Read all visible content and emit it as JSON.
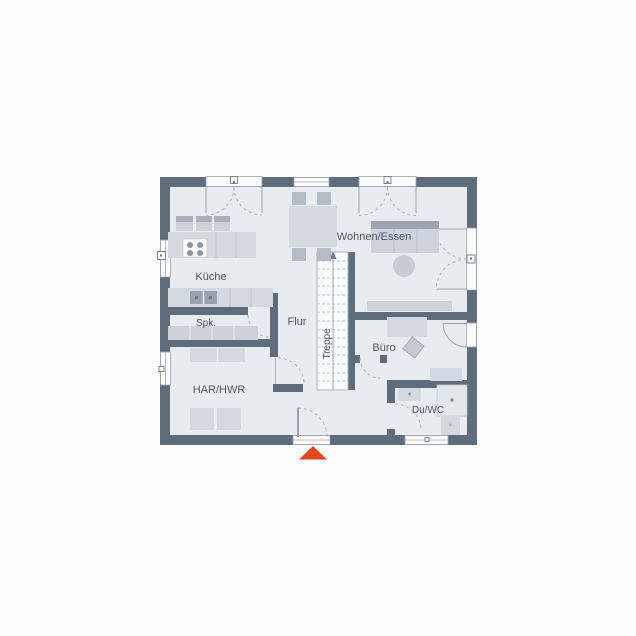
{
  "floorplan": {
    "rooms": {
      "kitchen": "Küche",
      "pantry": "Spk.",
      "hallway": "Flur",
      "stairs": "Treppe",
      "living_dining": "Wohnen/Essen",
      "office": "Büro",
      "utility": "HAR/HWR",
      "shower_wc": "Du/WC"
    },
    "icons": {
      "entrance_marker": "entrance-arrow-triangle",
      "stair_direction": "up-arrow"
    },
    "colors": {
      "wall": "#5E6C7C",
      "floor": "#E8ECF1",
      "stair_fill": "#FBFCFD",
      "furniture_light": "#D3D9E0",
      "furniture_mid": "#C3CAD2",
      "furniture_dark": "#9AA5B0",
      "appliance_dark": "#98A2AD",
      "swing_line": "#A8B1BB",
      "label_text": "#4C5763",
      "entrance_marker": "#E2491F"
    }
  }
}
